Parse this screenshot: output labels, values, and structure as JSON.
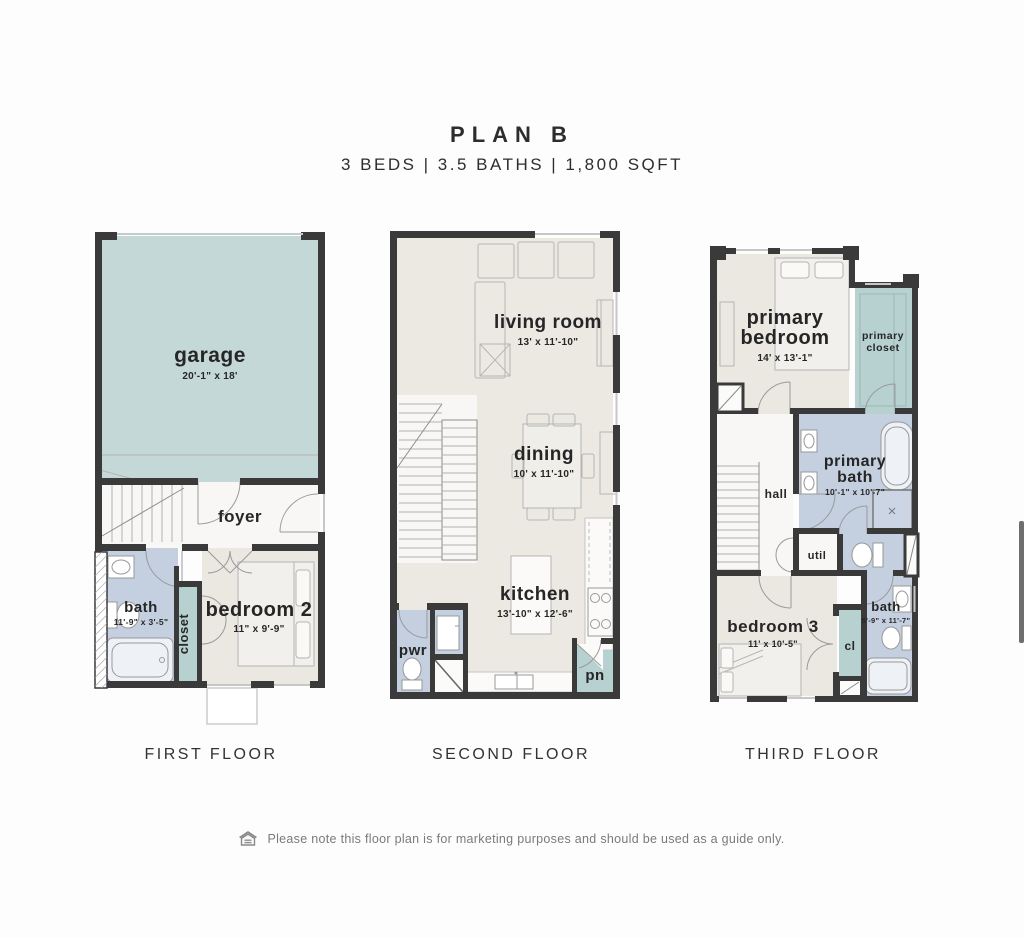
{
  "header": {
    "title": "PLAN B",
    "subtitle": "3 BEDS | 3.5 BATHS | 1,800 SQFT"
  },
  "floors": {
    "first": {
      "label": "FIRST FLOOR",
      "garage": {
        "name": "garage",
        "dims": "20'-1\" x 18'"
      },
      "foyer": {
        "name": "foyer"
      },
      "bath": {
        "name": "bath",
        "dims": "11'-9\" x 3'-5\""
      },
      "closet": {
        "name": "closet"
      },
      "bedroom2": {
        "name": "bedroom 2",
        "dims": "11\" x 9'-9\""
      }
    },
    "second": {
      "label": "SECOND FLOOR",
      "living": {
        "name": "living room",
        "dims": "13' x 11'-10\""
      },
      "dining": {
        "name": "dining",
        "dims": "10' x 11'-10\""
      },
      "kitchen": {
        "name": "kitchen",
        "dims": "13'-10\" x 12'-6\""
      },
      "pwr": {
        "name": "pwr"
      },
      "pantry": {
        "name": "pn"
      }
    },
    "third": {
      "label": "THIRD FLOOR",
      "primary_bedroom": {
        "line1": "primary",
        "line2": "bedroom",
        "dims": "14' x 13'-1\""
      },
      "primary_closet": {
        "line1": "primary",
        "line2": "closet"
      },
      "hall": {
        "name": "hall"
      },
      "primary_bath": {
        "line1": "primary",
        "line2": "bath",
        "dims": "10'-1\" x 10'-7\""
      },
      "util": {
        "name": "util"
      },
      "bedroom3": {
        "name": "bedroom 3",
        "dims": "11' x 10'-5\""
      },
      "closet": {
        "name": "cl"
      },
      "bath": {
        "name": "bath",
        "dims": "5'-9\" x 11'-7\""
      }
    }
  },
  "footer": {
    "icon": "house-icon",
    "text": "Please note this floor plan is for marketing purposes and should be used as a guide only."
  },
  "colors": {
    "wall": "#3a3a3a",
    "garage_fill": "#c4d8d8",
    "bath_fill": "#c4cfe0",
    "closet_fill": "#b6d1cf",
    "room_fill": "#ebe8e1",
    "line": "#b5b5b5"
  }
}
